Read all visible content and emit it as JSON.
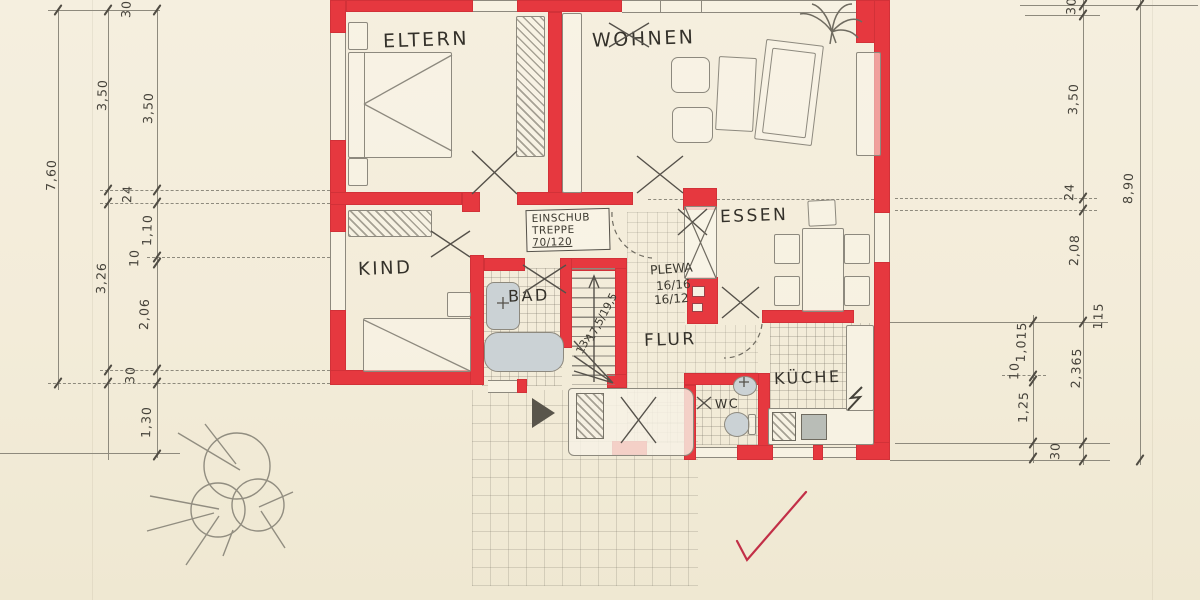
{
  "plan": {
    "type": "hand-drawn floor plan (Grundriss)",
    "rooms": {
      "eltern": "ELTERN",
      "wohnen": "WOHNEN",
      "kind": "KIND",
      "bad": "BAD",
      "essen": "ESSEN",
      "flur": "FLUR",
      "wc": "WC",
      "kueche": "KÜCHE"
    },
    "annotations": {
      "stair_box_line1": "EINSCHUB",
      "stair_box_line2": "TREPPE",
      "stair_box_line3": "70/120",
      "chimney_brand": "PLEWA",
      "chimney_dim1": "16/16",
      "chimney_dim2": "16/12",
      "stair_count": "13x",
      "stair_rise_run": "17,5/19,5"
    },
    "dimensions": {
      "left_outer_total": "7,60",
      "left_mid": [
        "3,50",
        "3,26"
      ],
      "left_inner": [
        "30",
        "3,50",
        "24",
        "1,10",
        "10",
        "2,06",
        "30",
        "1,30"
      ],
      "right_outer_total": "8,90",
      "right_inner": [
        "30",
        "3,50",
        "24",
        "2,08",
        "115",
        "2,365",
        "30"
      ],
      "right_detail": [
        "1,015",
        "10",
        "1,25"
      ]
    },
    "colors": {
      "paper": "#f3edda",
      "wall_red": "#e6383f",
      "pencil": "#8d897e",
      "ink": "#35322b",
      "fixture_fill": "#cbd2d5",
      "check_red": "#c22f47"
    }
  }
}
